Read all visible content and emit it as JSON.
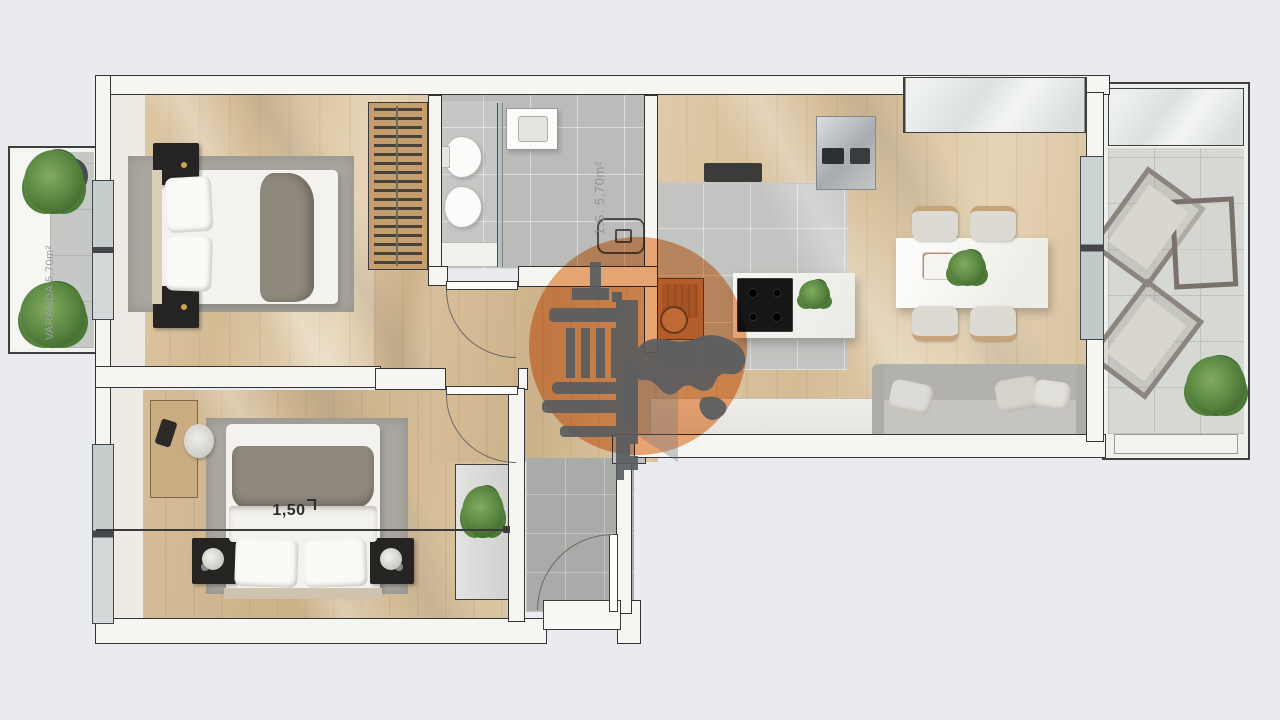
{
  "meta": {
    "type": "architectural-floor-plan",
    "width_px": 1280,
    "height_px": 720
  },
  "labels": {
    "bathroom_area": "1.S. 5,70m²",
    "balcony_area": "VARANDA 5,70m²",
    "bed_width": "1,50"
  },
  "watermark": {
    "shape": "orange-circle",
    "logo": "classical-column-with-map-silhouette",
    "circle_color": "#e8924f",
    "logo_color": "#575c60"
  },
  "colors": {
    "background": "#e9ebee",
    "wall_fill": "#f5f5f2",
    "wall_line": "#343434",
    "wood_floor": "#d9c3a0",
    "bath_tile": "#c2c4c1",
    "entry_tile": "#a9aba8",
    "balcony_tile": "#d6d8d4",
    "rug": "#a9a7a0",
    "sofa": "#b9b7b1",
    "nightstand": "#262422",
    "plant": "#5c8943",
    "dimension_text": "#2d2d2d"
  },
  "rooms": [
    {
      "name": "bedroom-1",
      "furniture": [
        "double-bed",
        "two-nightstands",
        "wardrobe-with-clothes",
        "rug",
        "window"
      ]
    },
    {
      "name": "bedroom-2",
      "furniture": [
        "double-bed",
        "two-nightstands-with-lamps",
        "desk",
        "chair",
        "rug",
        "window"
      ]
    },
    {
      "name": "bathroom",
      "furniture": [
        "toilet",
        "bidet",
        "washbasin",
        "glass-partition",
        "shower-drain"
      ]
    },
    {
      "name": "kitchen",
      "furniture": [
        "counter",
        "hood",
        "sink-appliance-block",
        "island-with-cooktop",
        "breakfast-table",
        "stool"
      ]
    },
    {
      "name": "living-dining",
      "furniture": [
        "dining-table",
        "four-chairs",
        "sofa",
        "sideboard",
        "large-window",
        "sliding-door"
      ]
    },
    {
      "name": "entry-hall",
      "furniture": [
        "front-door",
        "cabinet-with-plant"
      ]
    },
    {
      "name": "balcony-left",
      "furniture": [
        "plant",
        "plant"
      ]
    },
    {
      "name": "balcony-right",
      "furniture": [
        "lounge-chair",
        "lounge-chair",
        "side-table",
        "plant"
      ]
    }
  ]
}
